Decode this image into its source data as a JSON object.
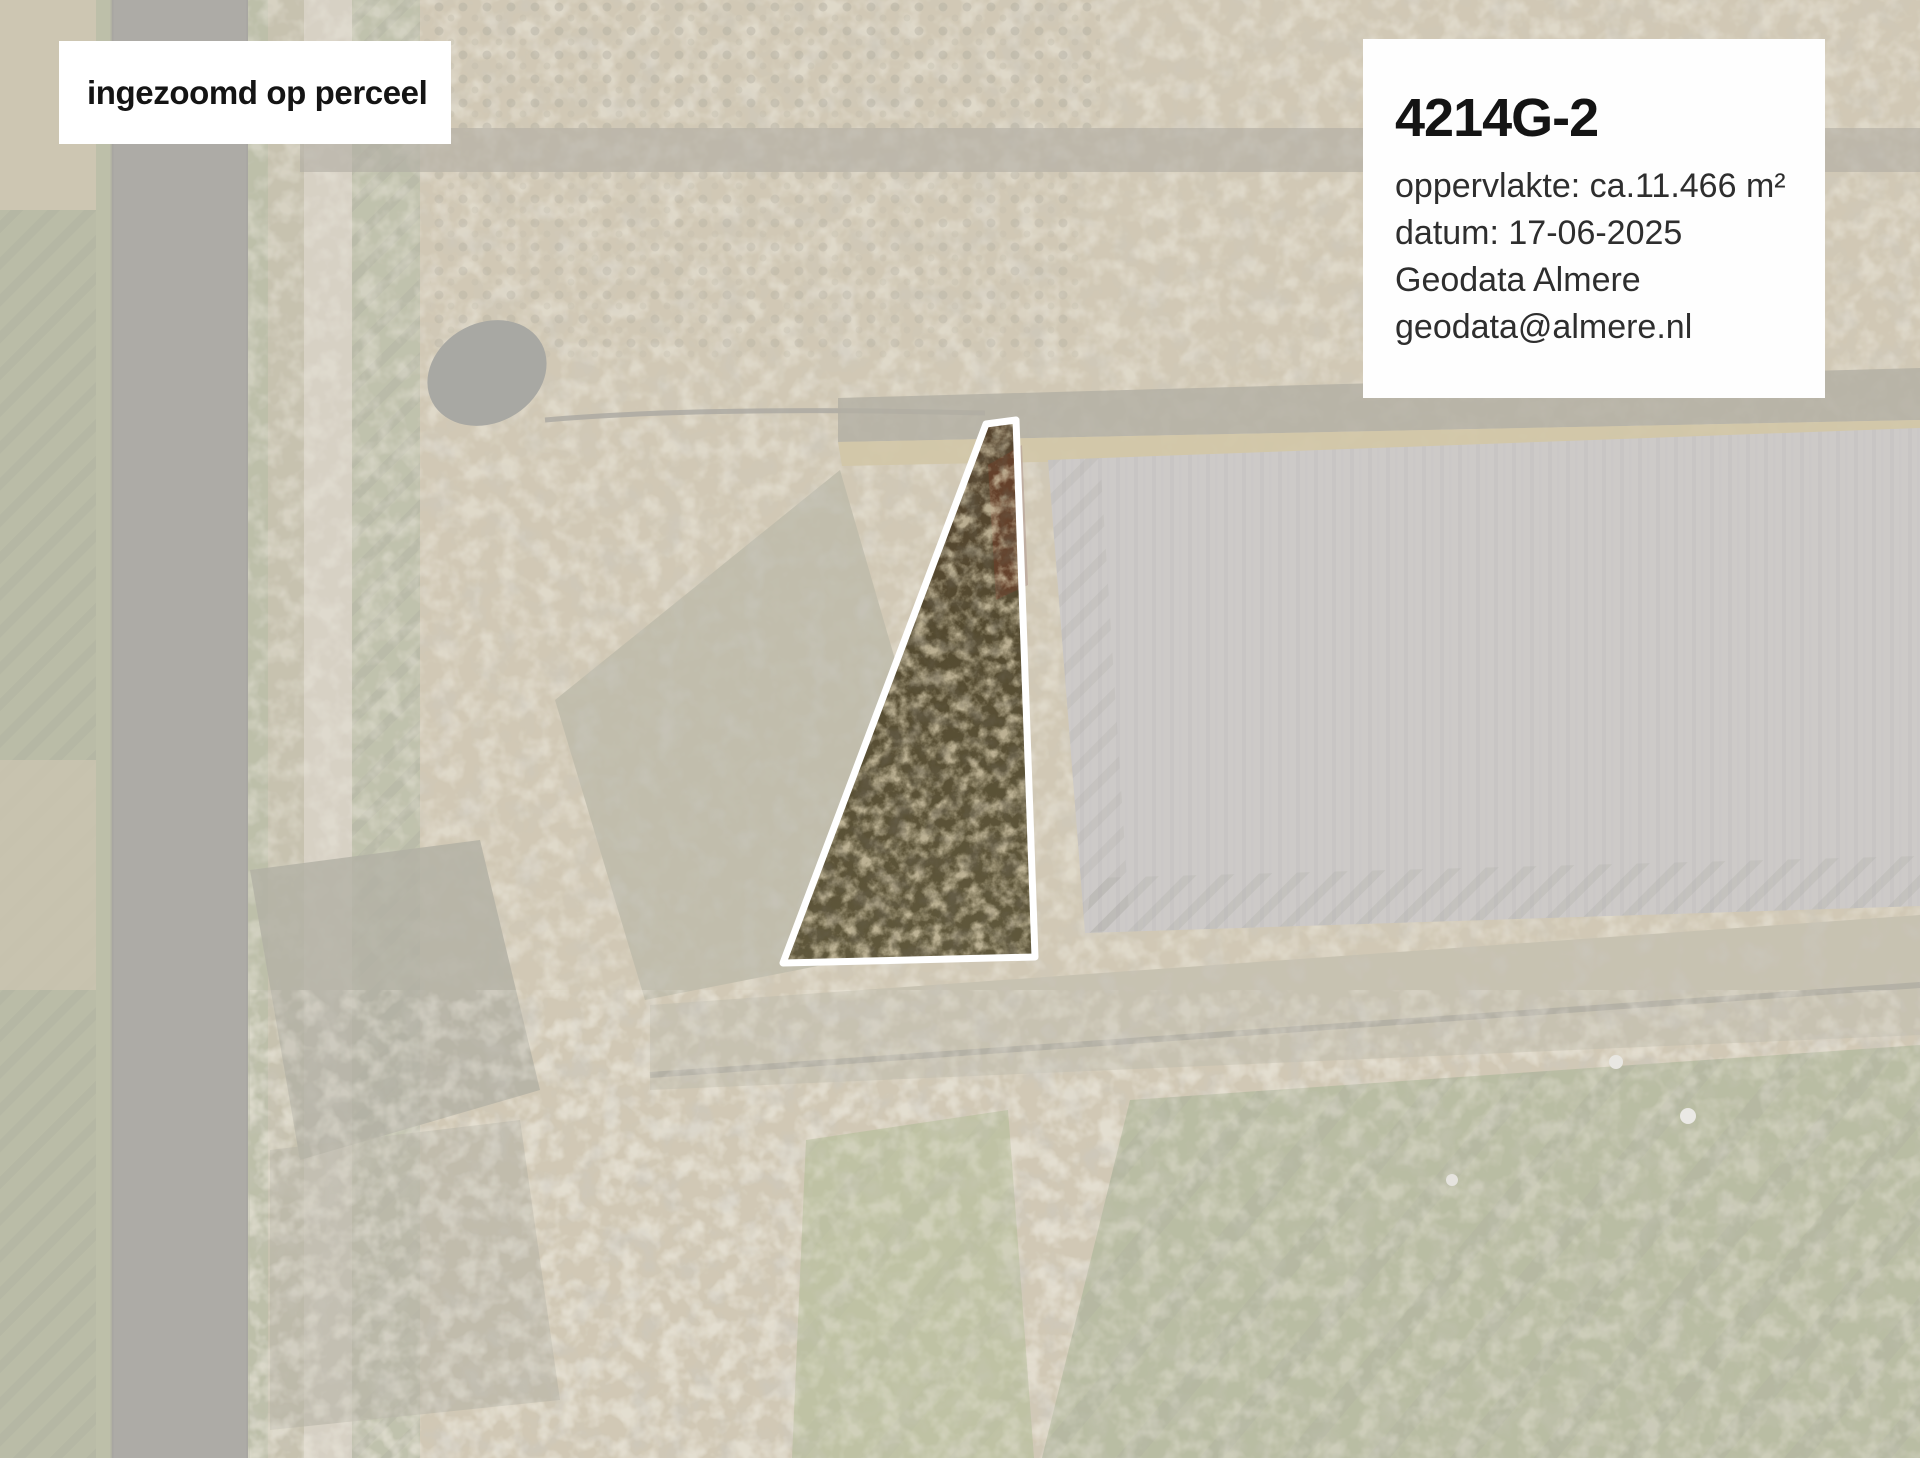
{
  "page": {
    "kind": "aerial-parcel-map",
    "width_px": 1920,
    "height_px": 1458
  },
  "overlay_label": {
    "text": "ingezoomd op perceel"
  },
  "info_box": {
    "title": "4214G-2",
    "lines": [
      "oppervlakte: ca.11.466 m²",
      "datum: 17-06-2025",
      "Geodata Almere",
      "geodata@almere.nl"
    ]
  },
  "parcel": {
    "id_label": "4214G-2",
    "outline_color": "#ffffff",
    "fade_overlay_color": "#ffffff",
    "fade_overlay_opacity": "0.52"
  }
}
